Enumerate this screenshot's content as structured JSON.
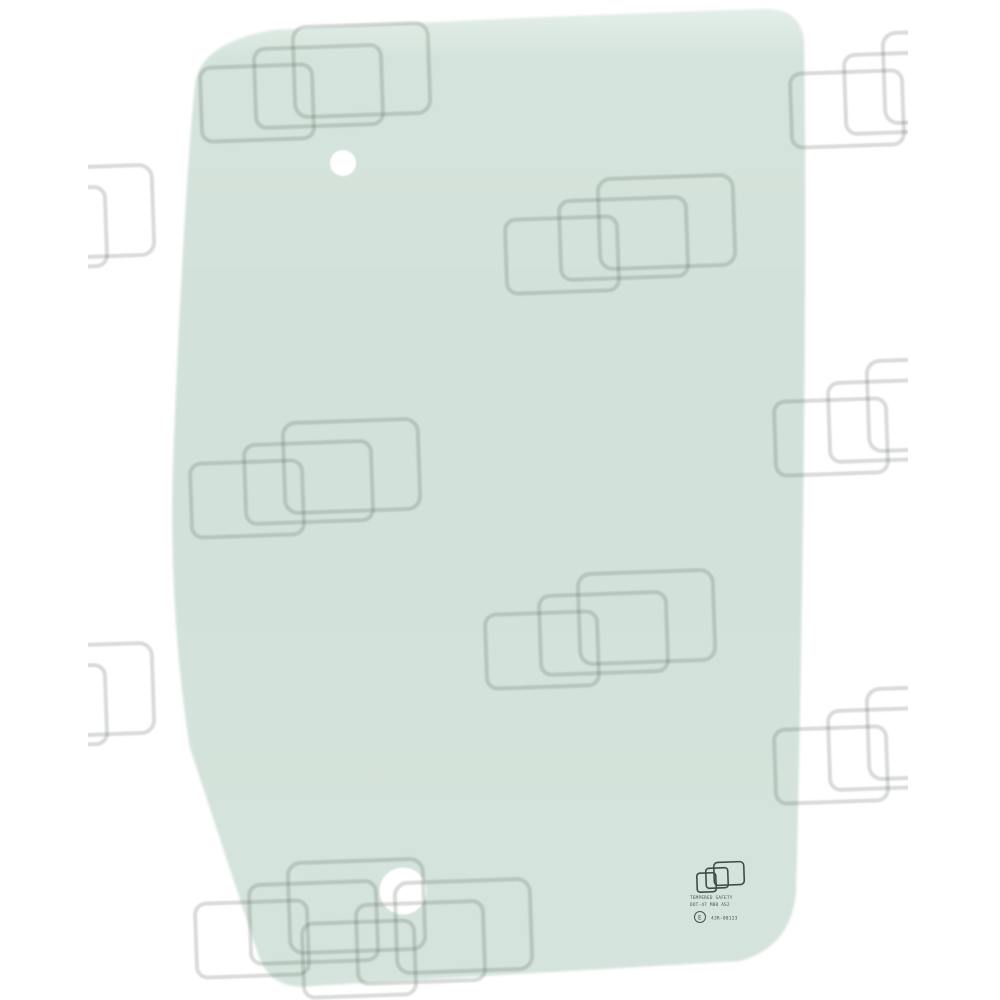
{
  "image": {
    "description": "Product photo of a tinted green cab door window glass panel with two mounting holes, shown over a white background with a repeating watermark pattern of overlapping rounded rectangles",
    "background_color": "#ffffff"
  },
  "glass": {
    "tint_color": "#d2e1d9",
    "tint_color_mid": "#d4e3db",
    "highlight_color": "#e4eee8",
    "holes": [
      {
        "name": "upper-mounting-hole",
        "cx": 343,
        "cy": 163,
        "r": 13
      },
      {
        "name": "lower-mounting-hole",
        "cx": 403,
        "cy": 891,
        "r": 23.5
      }
    ]
  },
  "watermark": {
    "stroke_color": "#5a6860",
    "opacity": 0.24,
    "tiles": [
      {
        "x": 198,
        "y": 24
      },
      {
        "x": 788,
        "y": 30
      },
      {
        "x": -78,
        "y": 166
      },
      {
        "x": 503,
        "y": 176
      },
      {
        "x": 772,
        "y": 358
      },
      {
        "x": 188,
        "y": 420
      },
      {
        "x": 483,
        "y": 571
      },
      {
        "x": -78,
        "y": 644
      },
      {
        "x": 772,
        "y": 686
      },
      {
        "x": 193,
        "y": 860
      },
      {
        "x": 300,
        "y": 880
      }
    ]
  },
  "stamp": {
    "logo": "overlapping-rectangles-logo",
    "line1": "TEMPERED SAFETY",
    "line2": "DOT-47 M88 AS2",
    "e_mark": "E",
    "line3": "43R-00123",
    "color": "#47524b"
  }
}
